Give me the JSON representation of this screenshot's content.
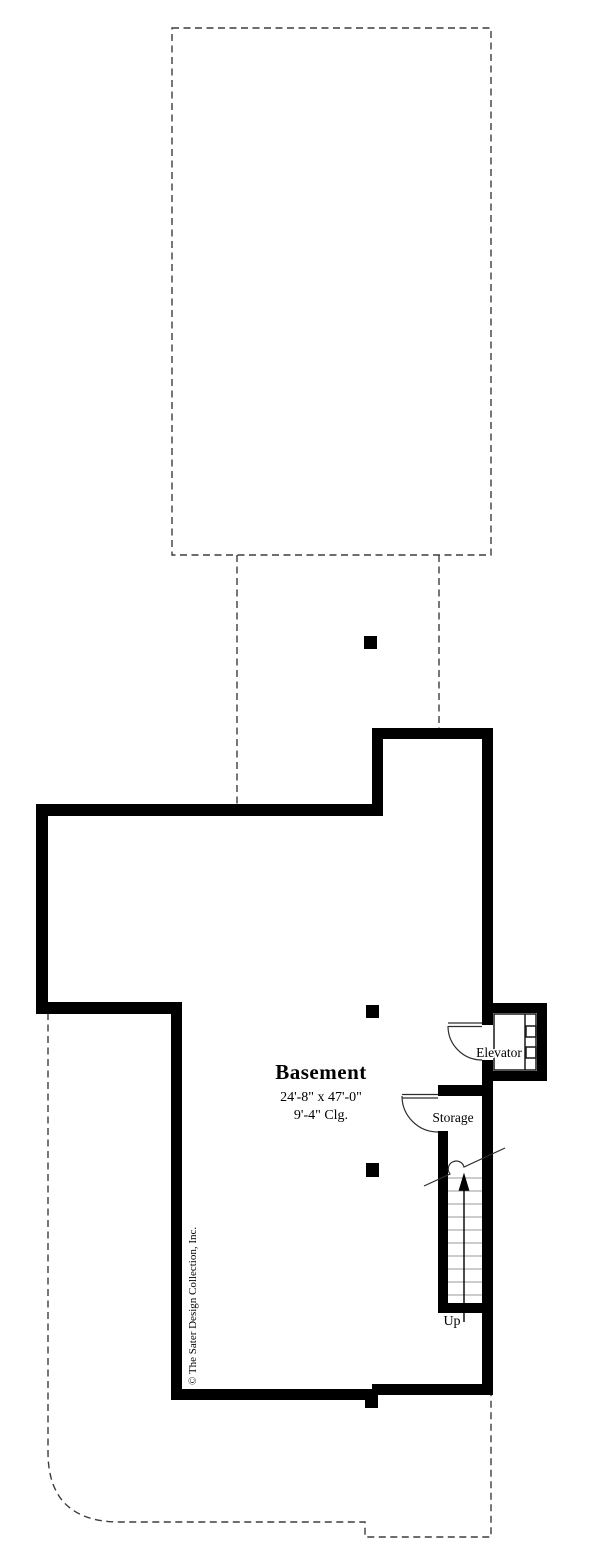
{
  "labels": {
    "room": "Basement",
    "dimensions": "24'-8\" x 47'-0\"",
    "ceiling": "9'-4\" Clg.",
    "elevator": "Elevator",
    "storage": "Storage",
    "stairs_direction": "Up",
    "copyright": "© The Sater Design Collection, Inc."
  },
  "colors": {
    "background": "#ffffff",
    "wall": "#000000",
    "dashed_line": "#3d3d3d",
    "stair_tread": "#9a9a9a",
    "door_swing": "#2e2e2e",
    "shaft_line": "#1a1a1a",
    "text": "#000000"
  }
}
